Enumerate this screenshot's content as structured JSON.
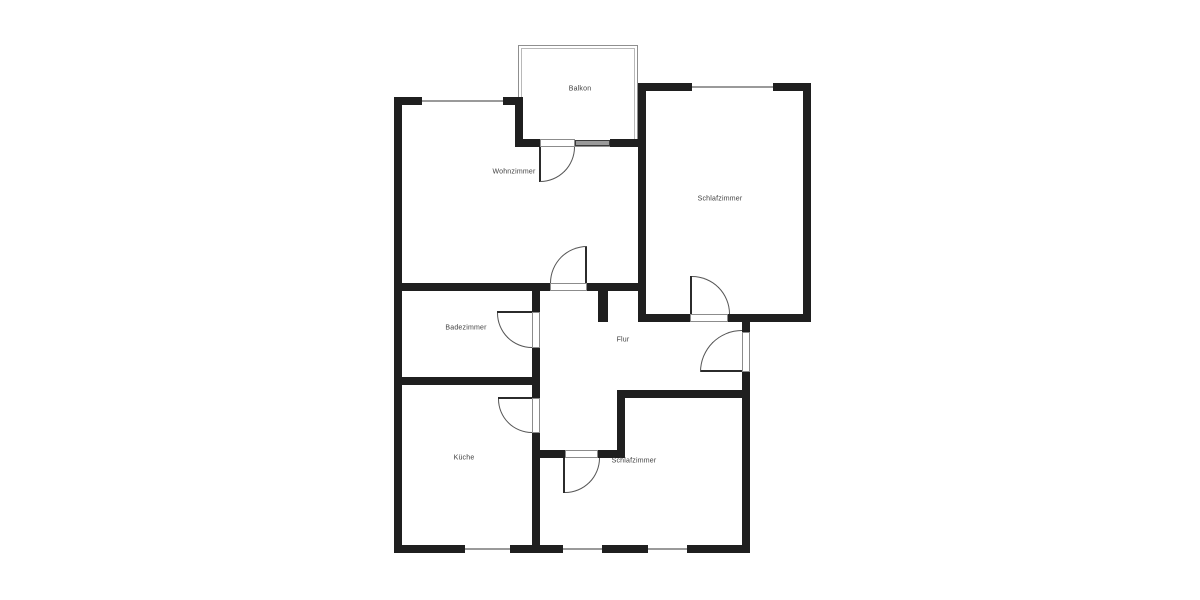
{
  "figure": {
    "kind": "floor-plan",
    "width": 1200,
    "height": 600
  },
  "colors": {
    "wall": "#1f1f1f",
    "window_line": "#9a9a9a",
    "door_jamb": "#8c8c8c",
    "door_leaf": "#2b2b2b",
    "swing_arc": "#555555",
    "balcony_outline": "#8f8f8f",
    "label": "#404040",
    "background": "#ffffff"
  },
  "rooms": [
    {
      "label": "Balkon",
      "cx": 580,
      "cy": 89
    },
    {
      "label": "Wohnzimmer",
      "cx": 514,
      "cy": 172
    },
    {
      "label": "Schlafzimmer",
      "cx": 720,
      "cy": 199
    },
    {
      "label": "Badezimmer",
      "cx": 466,
      "cy": 328
    },
    {
      "label": "Flur",
      "cx": 623,
      "cy": 340
    },
    {
      "label": "Küche",
      "cx": 464,
      "cy": 458
    },
    {
      "label": "Schlafzimmer",
      "cx": 634,
      "cy": 461
    }
  ],
  "geometry": {
    "walls": [
      [
        394,
        97,
        8,
        456
      ],
      [
        394,
        97,
        28,
        8
      ],
      [
        503,
        97,
        20,
        8
      ],
      [
        515,
        97,
        8,
        50
      ],
      [
        515,
        139,
        25,
        8
      ],
      [
        610,
        139,
        36,
        8
      ],
      [
        638,
        83,
        8,
        239
      ],
      [
        638,
        83,
        54,
        8
      ],
      [
        773,
        83,
        38,
        8
      ],
      [
        803,
        83,
        8,
        239
      ],
      [
        638,
        314,
        52,
        8
      ],
      [
        728,
        314,
        83,
        8
      ],
      [
        742,
        314,
        8,
        18
      ],
      [
        742,
        372,
        8,
        181
      ],
      [
        394,
        283,
        156,
        8
      ],
      [
        587,
        283,
        59,
        8
      ],
      [
        598,
        291,
        10,
        31
      ],
      [
        532,
        291,
        8,
        21
      ],
      [
        532,
        348,
        8,
        50
      ],
      [
        532,
        433,
        8,
        112
      ],
      [
        394,
        377,
        146,
        8
      ],
      [
        538,
        450,
        27,
        8
      ],
      [
        598,
        450,
        27,
        8
      ],
      [
        617,
        390,
        8,
        68
      ],
      [
        617,
        390,
        133,
        8
      ],
      [
        394,
        545,
        71,
        8
      ],
      [
        510,
        545,
        53,
        8
      ],
      [
        602,
        545,
        46,
        8
      ],
      [
        687,
        545,
        63,
        8
      ]
    ],
    "windows": [
      [
        422,
        100,
        81,
        2
      ],
      [
        692,
        86,
        81,
        2
      ],
      [
        465,
        548,
        45,
        2
      ],
      [
        563,
        548,
        39,
        2
      ],
      [
        648,
        548,
        39,
        2
      ]
    ],
    "door_openings": [
      [
        550,
        283,
        37,
        8
      ],
      [
        540,
        139,
        35,
        8
      ],
      [
        532,
        312,
        8,
        36
      ],
      [
        532,
        398,
        8,
        35
      ],
      [
        690,
        314,
        38,
        8
      ],
      [
        742,
        332,
        8,
        40
      ],
      [
        565,
        450,
        33,
        8
      ]
    ],
    "door_leaves": [
      [
        539,
        147,
        2,
        35
      ],
      [
        585,
        246,
        2,
        37
      ],
      [
        497,
        311,
        35,
        2
      ],
      [
        498,
        397,
        34,
        2
      ],
      [
        690,
        276,
        2,
        38
      ],
      [
        700,
        370,
        42,
        2
      ],
      [
        563,
        458,
        2,
        35
      ]
    ],
    "door_arcs": [
      {
        "x": 540,
        "y": 147,
        "r": 35,
        "corner": "br"
      },
      {
        "x": 550,
        "y": 246,
        "r": 37,
        "corner": "tl"
      },
      {
        "x": 497,
        "y": 313,
        "r": 35,
        "corner": "bl"
      },
      {
        "x": 498,
        "y": 399,
        "r": 34,
        "corner": "bl"
      },
      {
        "x": 692,
        "y": 276,
        "r": 38,
        "corner": "tr"
      },
      {
        "x": 700,
        "y": 330,
        "r": 42,
        "corner": "tl"
      },
      {
        "x": 565,
        "y": 458,
        "r": 35,
        "corner": "br"
      }
    ],
    "balcony_outline": {
      "outer": [
        518,
        45,
        120,
        102
      ],
      "inner": [
        521,
        48,
        114,
        96
      ]
    },
    "balcony_sill": [
      575,
      140,
      35,
      6
    ]
  }
}
